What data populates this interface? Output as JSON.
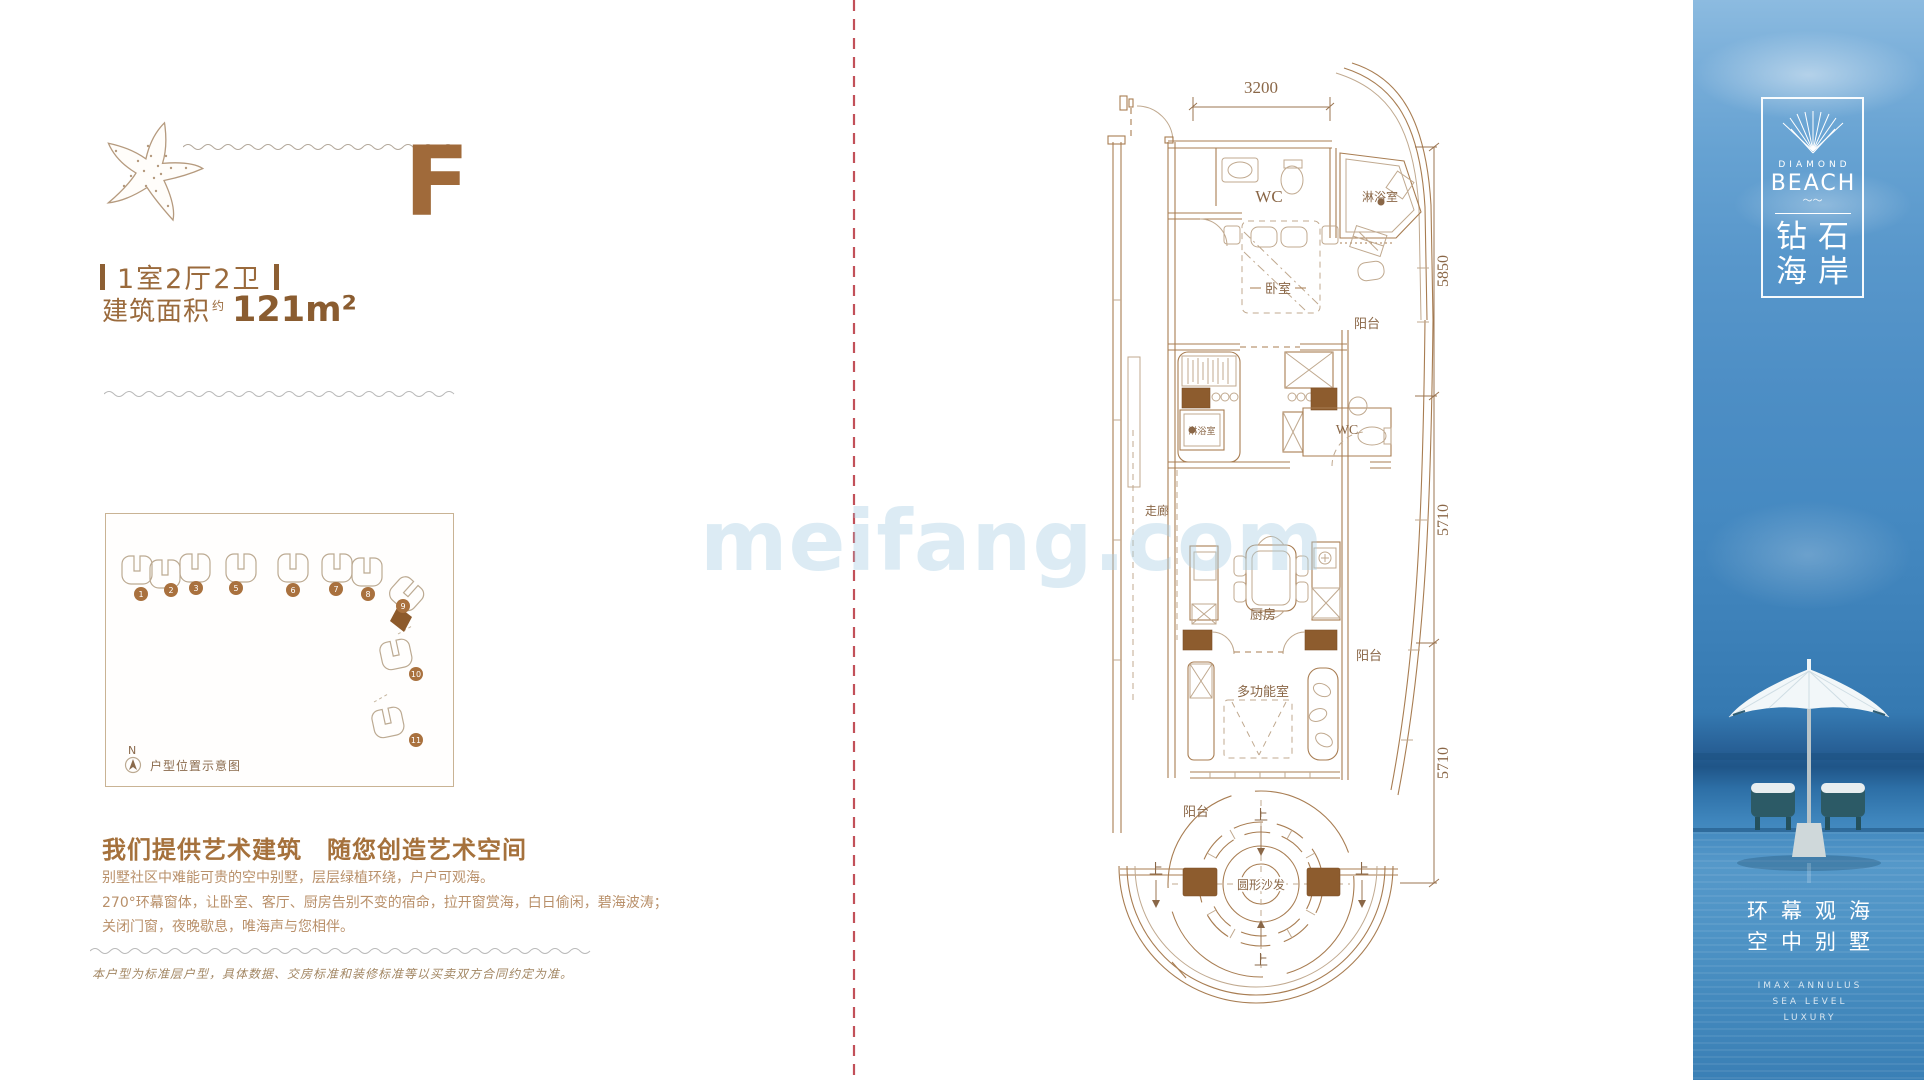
{
  "watermark": "meifang.com",
  "left_panel": {
    "unit_letter": "F",
    "layout_label": "1室2厅2卫",
    "area_label": "建筑面积",
    "area_sup": "约",
    "area_value": "121m²",
    "siteplan": {
      "north": "N",
      "caption": "户型位置示意图",
      "building_numbers": [
        "1",
        "2",
        "3",
        "5",
        "6",
        "7",
        "8",
        "9",
        "10",
        "11"
      ]
    },
    "slogan": "我们提供艺术建筑　随您创造艺术空间",
    "paragraph_lines": [
      "别墅社区中难能可贵的空中别墅，层层绿植环绕，户户可观海。",
      "270°环幕窗体，让卧室、客厅、厨房告别不变的宿命，拉开窗赏海，白日偷闲，碧海波涛；",
      "关闭门窗，夜晚歇息，唯海声与您相伴。"
    ],
    "disclaimer": "本户型为标准层户型，具体数据、交房标准和装修标准等以买卖双方合同约定为准。"
  },
  "floor_plan": {
    "dim_top": "3200",
    "dim_right_1": "5850",
    "dim_right_2": "5710",
    "dim_right_3": "5710",
    "labels": {
      "wc_top": "WC",
      "shower_annex": "淋浴室",
      "bedroom": "卧室",
      "balcony_upper": "阳台",
      "shower_mid": "淋浴室",
      "wc_mid": "WC",
      "corridor": "走廊",
      "kitchen": "厨房",
      "balcony_mid": "阳台",
      "multi_room": "多功能室",
      "balcony_bottom": "阳台",
      "round_sofa": "圆形沙发",
      "up_top": "上",
      "up_left": "上",
      "up_right": "上",
      "up_bottom": "上"
    }
  },
  "sidebar": {
    "logo_en_small": "DIAMOND",
    "logo_en_big": "BEACH",
    "logo_squiggle": "〜〜",
    "logo_cn_1": "钻石",
    "logo_cn_2": "海岸",
    "tagline_cn_1": "环幕观海",
    "tagline_cn_2": "空中别墅",
    "tagline_en_1": "IMAX ANNULUS",
    "tagline_en_2": "SEA LEVEL",
    "tagline_en_3": "LUXURY"
  },
  "colors": {
    "brand_brown": "#a06a3a",
    "wall_fill": "#8d5c2e",
    "line_brown": "#a87d52",
    "fold_line_red": "#c25059",
    "sidebar_blue_top": "#8cbbe0",
    "sidebar_blue_deep": "#1f5588"
  }
}
